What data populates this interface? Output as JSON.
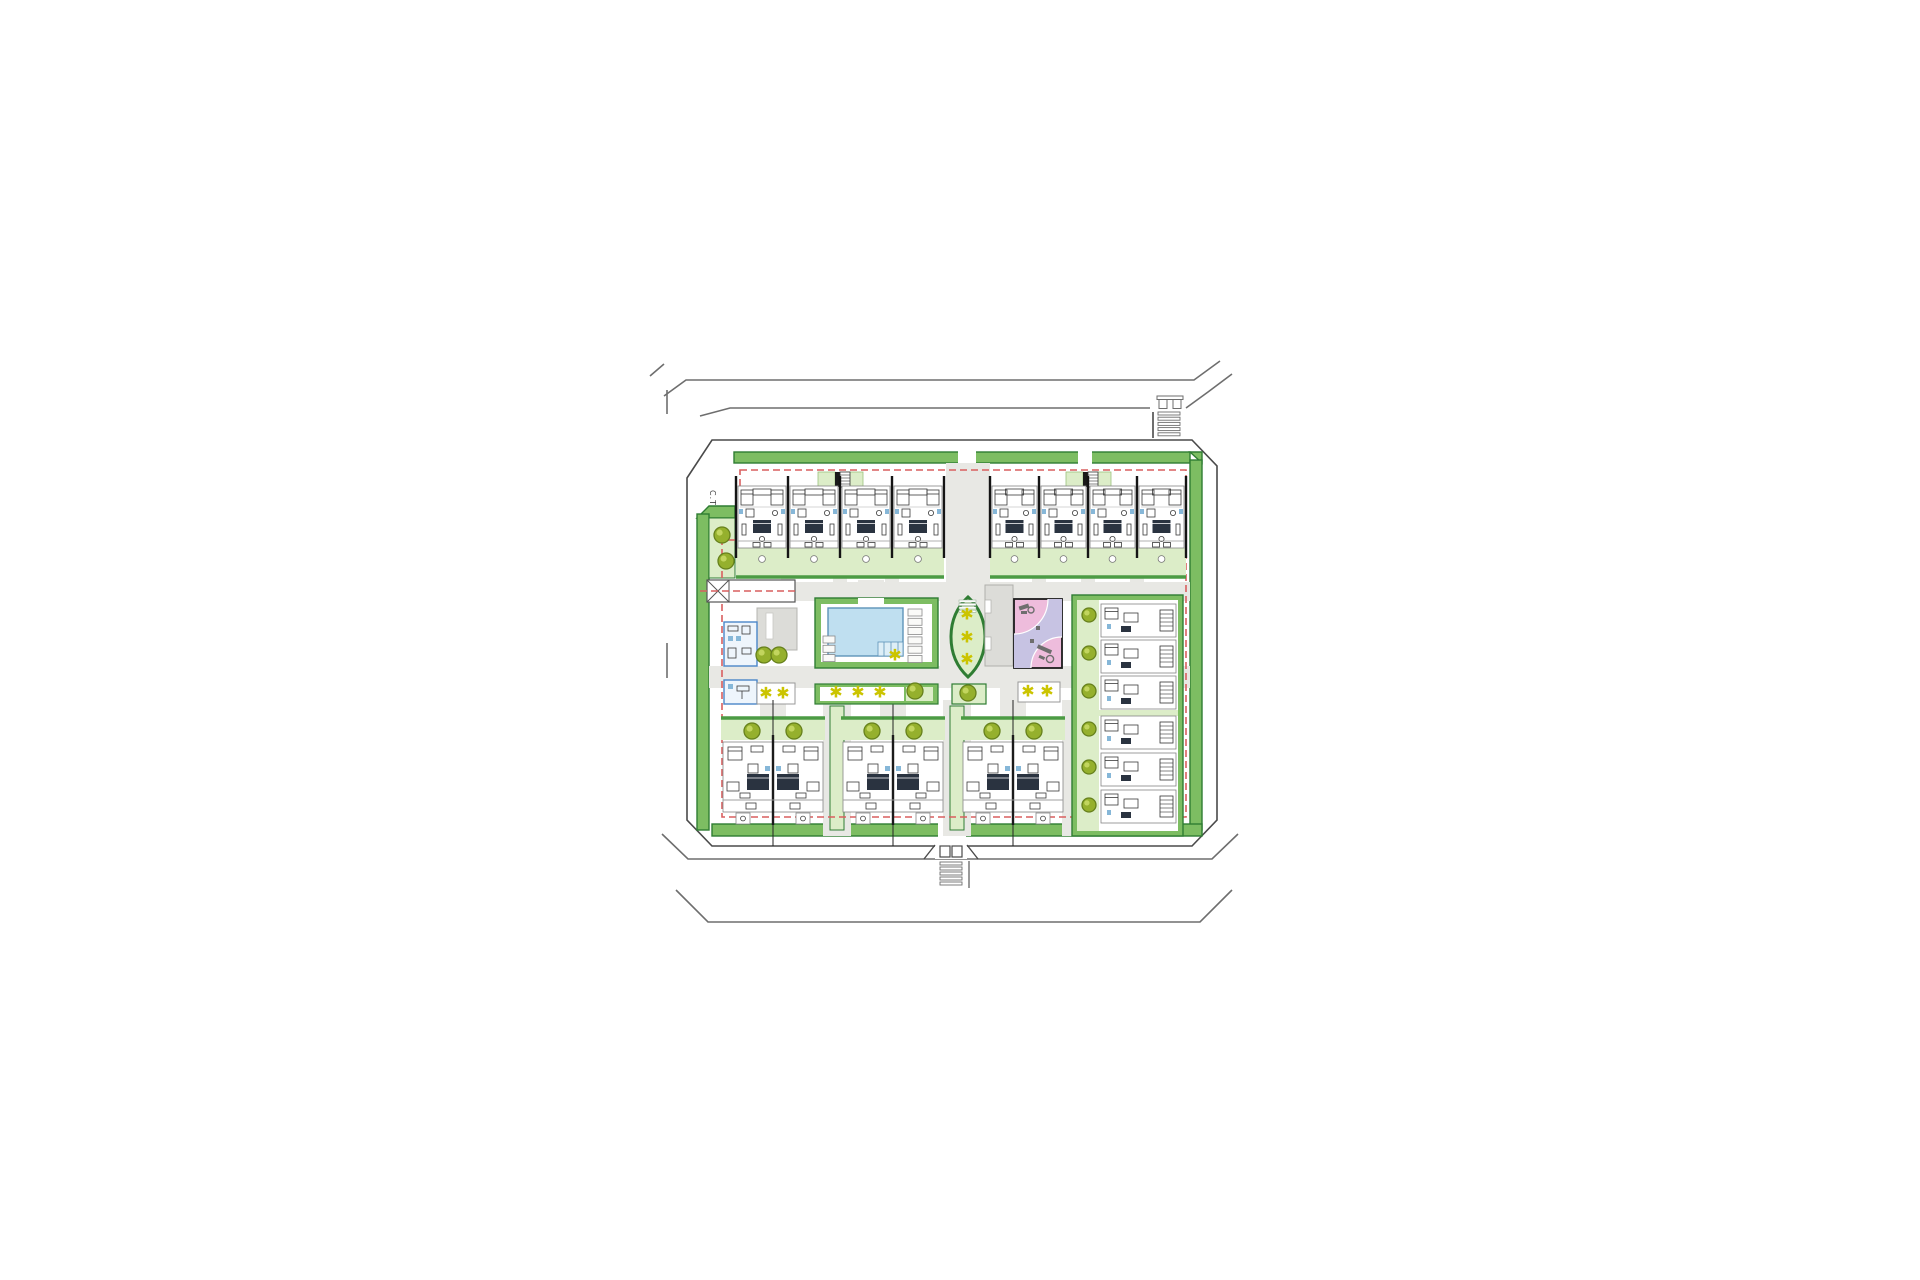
{
  "labels": {
    "ct": "C.T"
  },
  "palette": {
    "line": "#9a9a9a",
    "greenBand": "#7dbd62",
    "greenBandStroke": "#2f7d33",
    "lightGreen": "#dcedc8",
    "hedge": "#4c9b44",
    "treeFill": "#95b02d",
    "treeStroke": "#66801c",
    "treeHi": "#c2d55e",
    "star": "#cbc400",
    "path": "#e8e8e4",
    "poolWater": "#bfdff0",
    "poolStroke": "#5d93b8",
    "poolSteps": "#ddeef7",
    "pink": "#eebcdc",
    "lavender": "#c7c3e3",
    "equipment": "#6e6e6e",
    "blueBldg": "#4a86c8",
    "blueBldgFill": "#eef5fc",
    "fixture": "#86b7d8",
    "red": "#d95f5f",
    "slab": "#dcdcd8",
    "bedDark": "#2a3340"
  },
  "site": {
    "trees": [
      [
        722,
        535
      ],
      [
        726,
        561
      ],
      [
        764,
        655
      ],
      [
        779,
        655
      ],
      [
        915,
        691
      ],
      [
        968,
        693
      ],
      [
        752,
        731
      ],
      [
        794,
        731
      ],
      [
        872,
        731
      ],
      [
        914,
        731
      ],
      [
        992,
        731
      ],
      [
        1034,
        731
      ]
    ],
    "right_column_trees": {
      "x": 1089,
      "ys": [
        615,
        653,
        691,
        729,
        767,
        805
      ]
    },
    "stars": [
      [
        895,
        655
      ],
      [
        836,
        692
      ],
      [
        858,
        692
      ],
      [
        880,
        692
      ],
      [
        766,
        693
      ],
      [
        783,
        693
      ],
      [
        1028,
        691
      ],
      [
        1047,
        691
      ],
      [
        967,
        614
      ],
      [
        967,
        637
      ],
      [
        967,
        659
      ]
    ]
  },
  "top_blocks": [
    {
      "x": 736,
      "unit_w": 52,
      "units": 4,
      "core_cx": 840
    },
    {
      "x": 990,
      "unit_w": 49,
      "units": 4,
      "core_cx": 1088
    }
  ],
  "bottom_blocks": [
    {
      "cx": 773
    },
    {
      "cx": 893
    },
    {
      "cx": 1013
    }
  ],
  "right_column": {
    "x": 1072,
    "y": 595,
    "w": 111,
    "h": 241,
    "stacks": [
      {
        "ys": [
          604,
          640,
          676
        ]
      },
      {
        "ys": [
          716,
          753,
          790
        ]
      }
    ]
  },
  "pool": {
    "sunbeds_right": 6,
    "sunbeds_left": 3
  },
  "oval_stars": 3,
  "zebra": {
    "top": {
      "x": 1158,
      "y": 412,
      "w": 22,
      "bars": 5,
      "step": 5.2
    },
    "bottom": {
      "x": 940,
      "y": 862,
      "w": 22,
      "bars": 5,
      "step": 5.0
    }
  }
}
